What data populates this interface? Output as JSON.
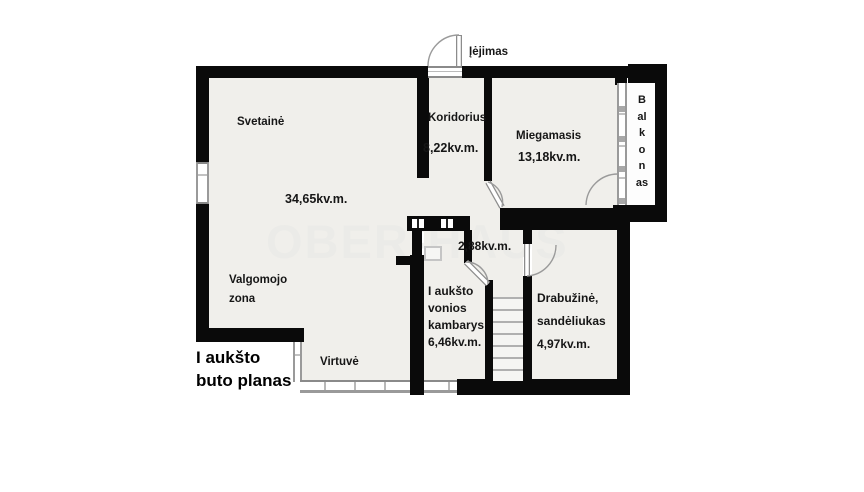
{
  "plan": {
    "title_line1": "I aukšto",
    "title_line2": "buto planas",
    "entrance": "Įėjimas",
    "watermark": "OBER-HAUS"
  },
  "rooms": {
    "svetaine": {
      "name": "Svetainė",
      "area": "34,65kv.m."
    },
    "koridorius": {
      "name": "Koridorius",
      "area": "8,22kv.m."
    },
    "miegamasis": {
      "name": "Miegamasis",
      "area": "13,18kv.m."
    },
    "balkonas": {
      "name": "Balkonas",
      "lines": [
        "B",
        "al",
        "k",
        "o",
        "n",
        "as"
      ]
    },
    "tualetas": {
      "area": "2,88kv.m."
    },
    "vonia": {
      "line1": "I aukšto",
      "line2": "vonios",
      "line3": "kambarys",
      "area": "6,46kv.m."
    },
    "drabuzine": {
      "line1": "Drabužinė,",
      "line2": "sandėliukas",
      "area": "4,97kv.m."
    },
    "valgomojo": {
      "line1": "Valgomojo",
      "line2": "zona"
    },
    "virtuve": {
      "name": "Virtuvė"
    }
  },
  "colors": {
    "wall": "#0a0a0a",
    "floor": "#f0efeb",
    "balcony_floor": "#fdfdfd",
    "watermark": "#ebebe8"
  }
}
